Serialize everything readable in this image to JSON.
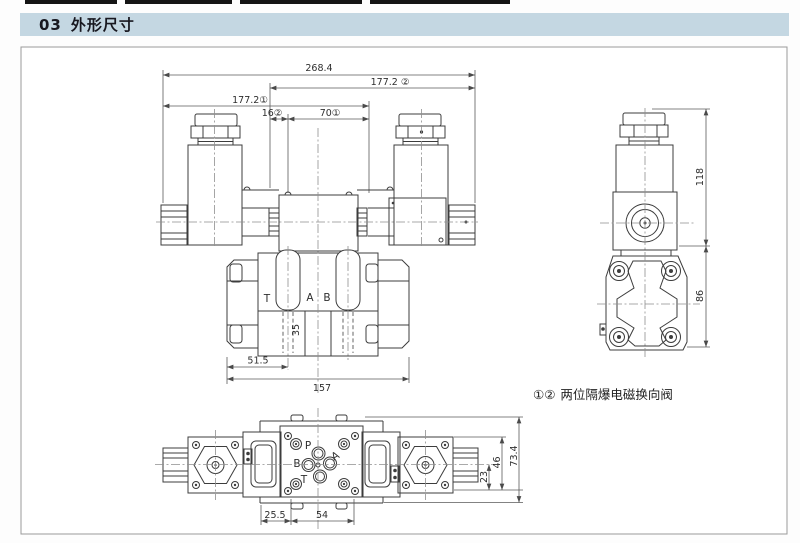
{
  "header": {
    "section_no": "03",
    "section_title": "外形尺寸"
  },
  "caption": {
    "marks": "①②",
    "text": "两位隔爆电磁换向阀"
  },
  "front_view": {
    "dim_total_width": "268.4",
    "dim_width_right": "177.2 ②",
    "dim_width_left": "177.2①",
    "dim_offset_16": "16②",
    "dim_offset_70": "70①",
    "dim_depth_35": "35",
    "dim_port_51_5": "51.5",
    "dim_base_157": "157",
    "ports": {
      "t": "T",
      "a": "A",
      "b": "B"
    }
  },
  "side_view": {
    "dim_height_118": "118",
    "dim_height_86": "86"
  },
  "top_view": {
    "dim_offset_25_5": "25.5",
    "dim_spacing_54": "54",
    "dim_offset_23": "23",
    "dim_spacing_46": "46",
    "dim_height_73_4": "73.4",
    "ports": {
      "p": "P",
      "a": "A",
      "b": "B",
      "t": "T"
    }
  },
  "colors": {
    "title_bar_bg": "#c4d7e2",
    "line": "#3c3c3c",
    "centerline": "#8f8f8f",
    "dim_text": "#2e2e2e",
    "frame_border": "#9a9a9a"
  }
}
